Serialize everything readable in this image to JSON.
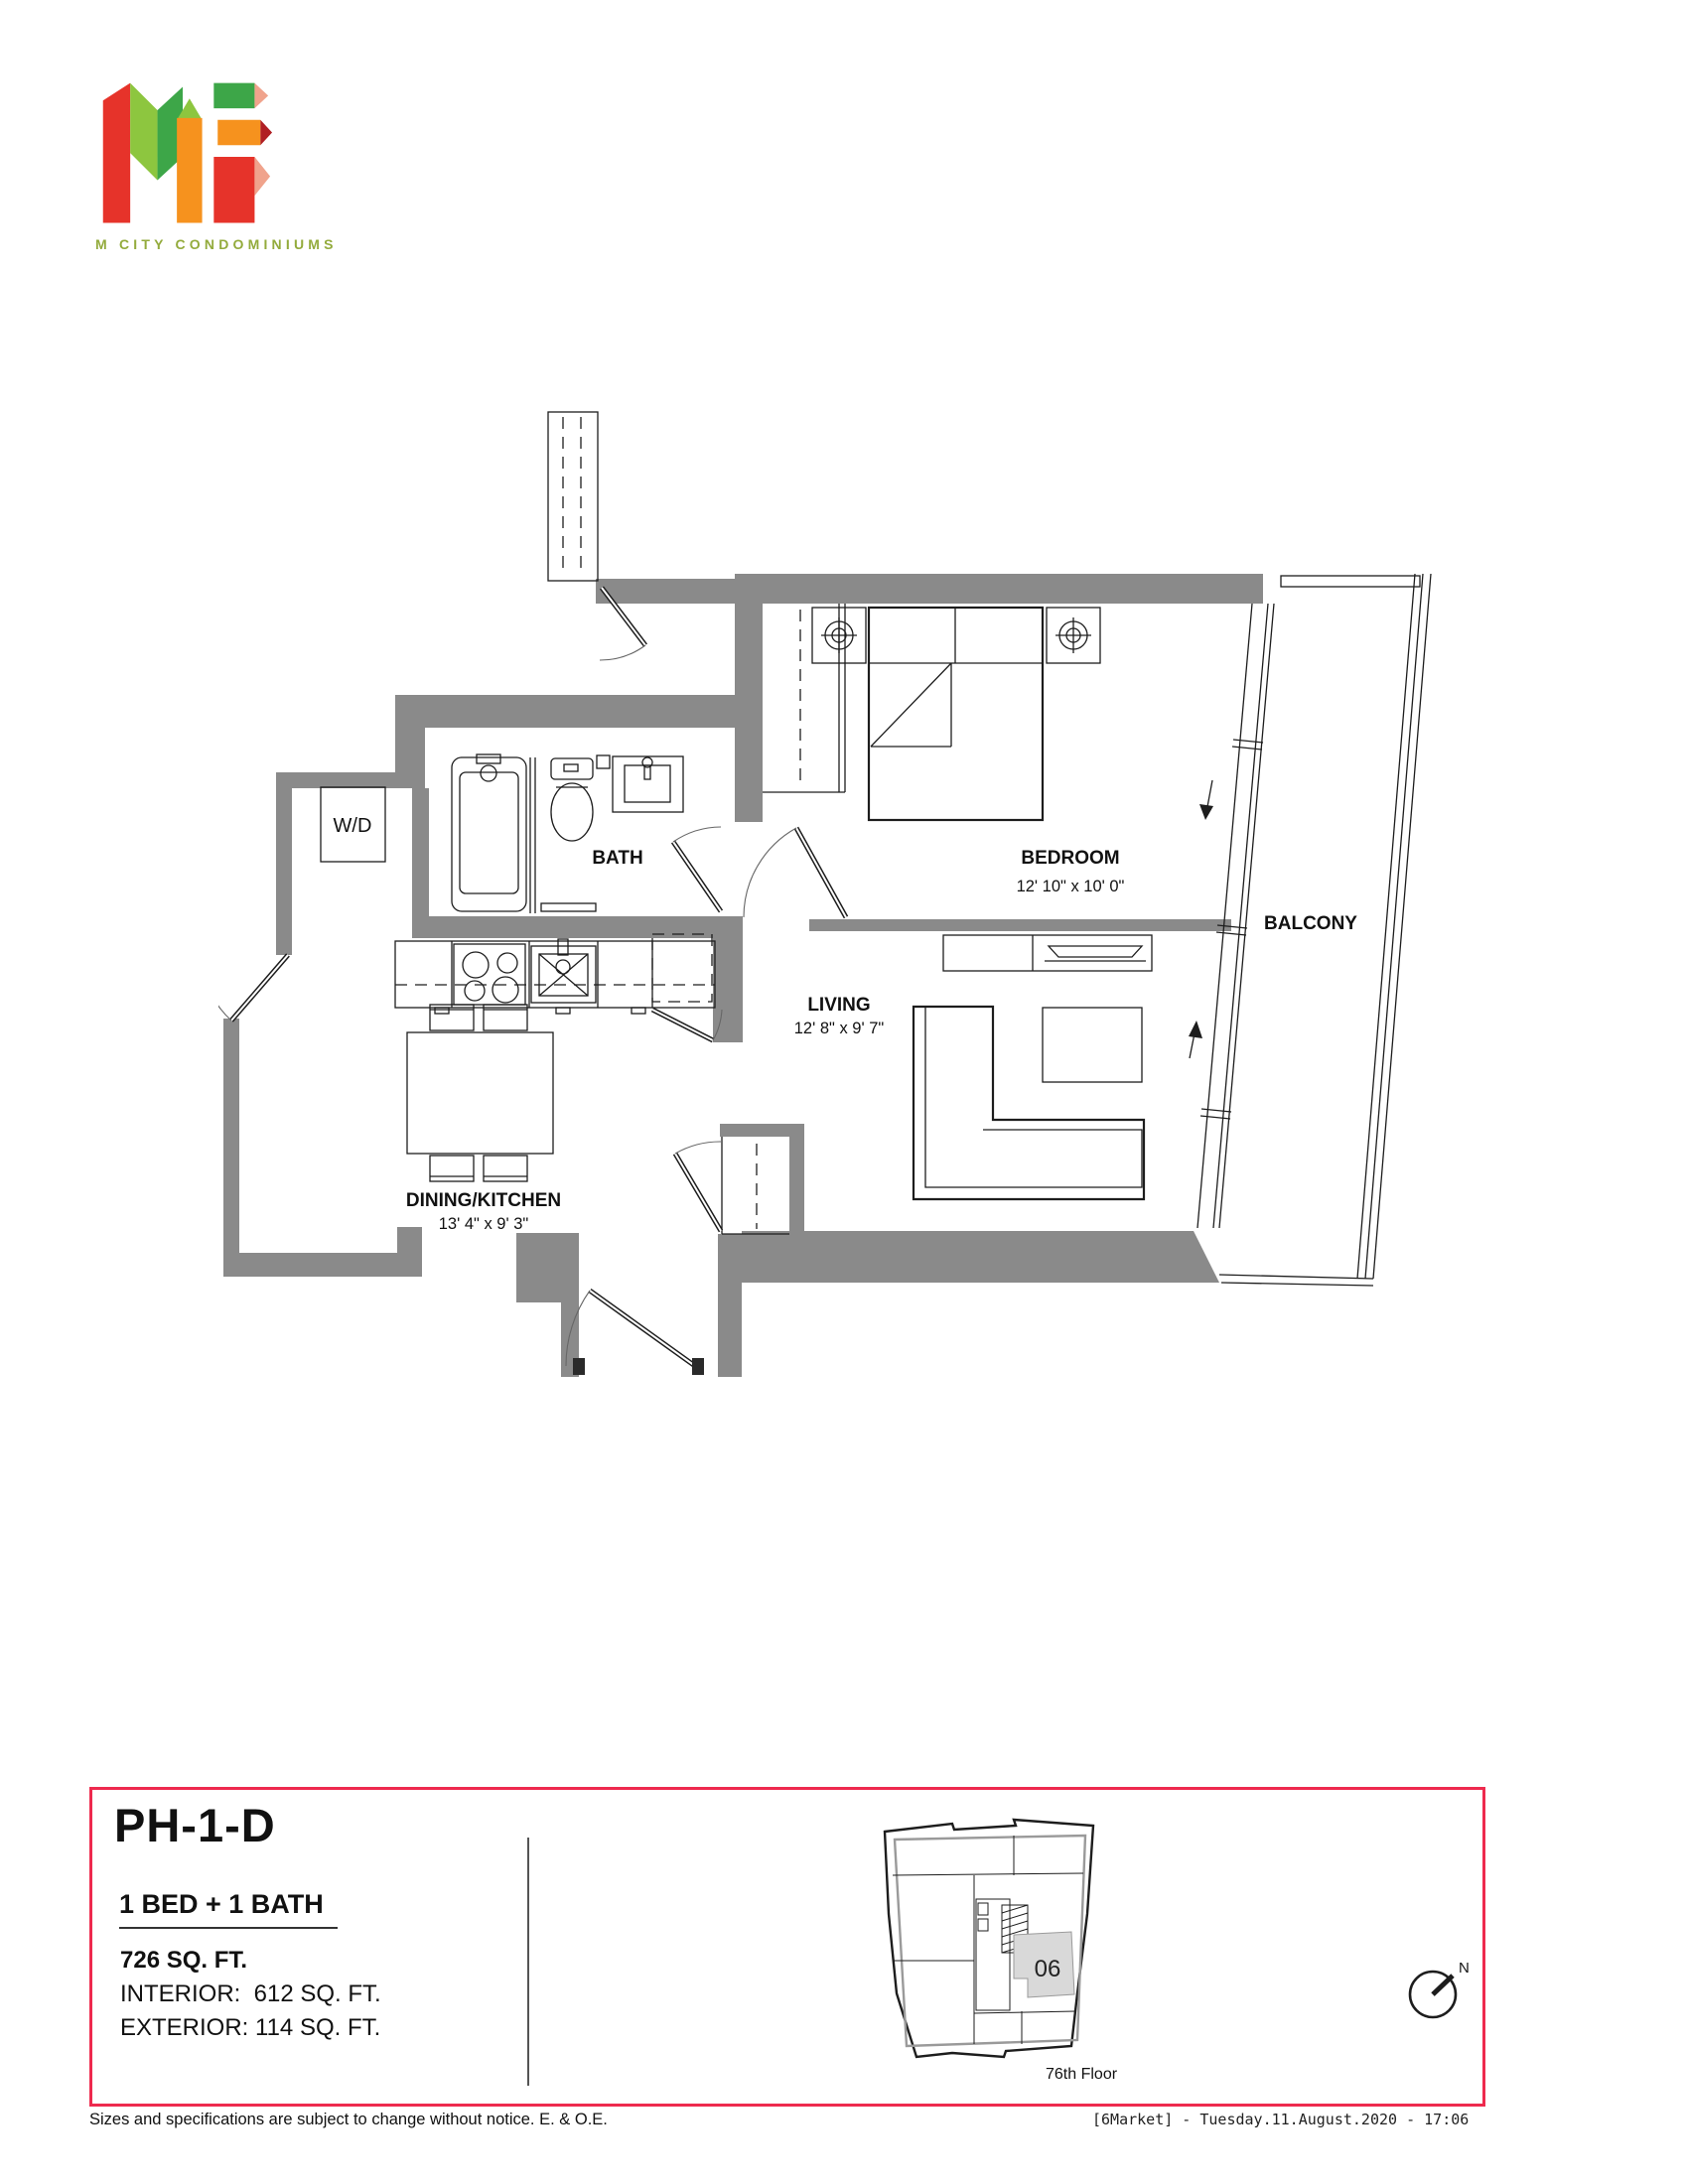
{
  "brand": {
    "logo": "M3",
    "tagline": "M CITY CONDOMINIUMS"
  },
  "floorplan": {
    "rooms": [
      {
        "name": "BEDROOM",
        "dims": "12' 10\" x 10' 0\""
      },
      {
        "name": "LIVING",
        "dims": "12' 8\" x 9' 7\""
      },
      {
        "name": "DINING/KITCHEN",
        "dims": "13' 4\" x 9' 3\""
      },
      {
        "name": "BATH",
        "dims": ""
      },
      {
        "name": "BALCONY",
        "dims": ""
      }
    ],
    "labels": {
      "washer_dryer": "W/D"
    }
  },
  "info": {
    "unit": "PH-1-D",
    "config": "1 BED + 1 BATH",
    "total_area": "726 SQ. FT.",
    "interior": "INTERIOR:  612 SQ. FT.",
    "exterior": "EXTERIOR: 114 SQ. FT."
  },
  "keyplan": {
    "unit_number": "06",
    "floor": "76th Floor"
  },
  "compass": {
    "north": "N"
  },
  "footer": {
    "disclaimer": "Sizes and specifications are subject to change without notice. E. & O.E.",
    "stamp": "[6Market] - Tuesday.11.August.2020 - 17:06"
  },
  "colors": {
    "wall_gray": "#8a8a8a",
    "accent_red": "#ee2a4e",
    "logo_green": "#93ab3c",
    "unit_highlight": "#d9d9d9"
  }
}
